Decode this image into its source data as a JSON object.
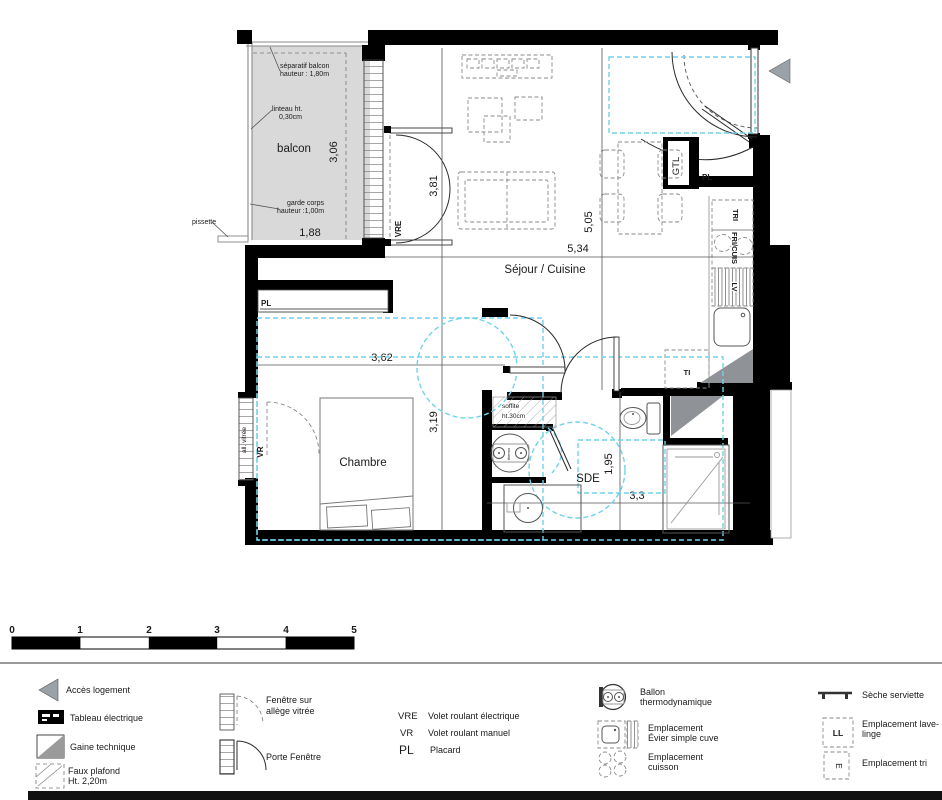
{
  "plan": {
    "room_balcon": "balcon",
    "room_sejour": "Séjour / Cuisine",
    "room_chambre": "Chambre",
    "room_sde": "SDE",
    "dim_balcon_w": "1,88",
    "dim_balcon_d": "3,06",
    "dim_baie": "3,81",
    "dim_sejour_w": "5,34",
    "dim_sejour_h": "5,05",
    "dim_chambre_w": "3,62",
    "dim_chambre_h": "3,19",
    "dim_sde_h": "1,95",
    "dim_sde_w": "3,3",
    "ann_separatif_1": "séparatif balcon",
    "ann_separatif_2": "hauteur : 1,80m",
    "ann_linteau_1": "linteau ht.",
    "ann_linteau_2": "0,30cm",
    "ann_garde_1": "garde corps",
    "ann_garde_2": "hauteur :1,00m",
    "ann_pissette": "pissette",
    "ann_soffite_1": "soffite",
    "ann_soffite_2": "ht.30cm",
    "lbl_vre": "VRE",
    "lbl_vr": "VR",
    "lbl_pl_chambre": "PL",
    "lbl_pl_entree": "PL",
    "lbl_gtl": "GTL",
    "lbl_tri": "TRI",
    "lbl_fricuis": "FRI/CUIS",
    "lbl_lv": "LV",
    "lbl_ti": "TI",
    "lbl_allvitree": "all. vitrée",
    "lbl_thermo": "thermo"
  },
  "scalebar": {
    "ticks": [
      "0",
      "1",
      "2",
      "3",
      "4",
      "5"
    ]
  },
  "legend": {
    "acces": "Accès  logement",
    "tableau": "Tableau électrique",
    "gaine": "Gaine technique",
    "faux_plafond_1": "Faux plafond",
    "faux_plafond_2": "Ht. 2,20m",
    "fenetre_1": "Fenêtre sur",
    "fenetre_2": "allège vitrée",
    "porte_fenetre": "Porte Fenêtre",
    "vre_abbr": "VRE",
    "vre_label": "Volet roulant électrique",
    "vr_abbr": "VR",
    "vr_label": "Volet roulant manuel",
    "pl_abbr": "PL",
    "pl_label": "Placard",
    "ballon_1": "Ballon",
    "ballon_2": "thermodynamique",
    "evier_1": "Emplacement",
    "evier_2": "Évier simple cuve",
    "cuisson_1": "Emplacement",
    "cuisson_2": "cuisson",
    "seche": "Sèche serviette",
    "ll_abbr": "LL",
    "lavelinge_1": "Emplacement lave-",
    "lavelinge_2": "linge",
    "tri_glyph": "E",
    "tri_label": "Emplacement tri"
  },
  "colors": {
    "zone_accent": "#6fd3ec",
    "balcony_fill": "#d9d9d9",
    "gaine_fill": "#8f9296",
    "wall": "#000000"
  }
}
